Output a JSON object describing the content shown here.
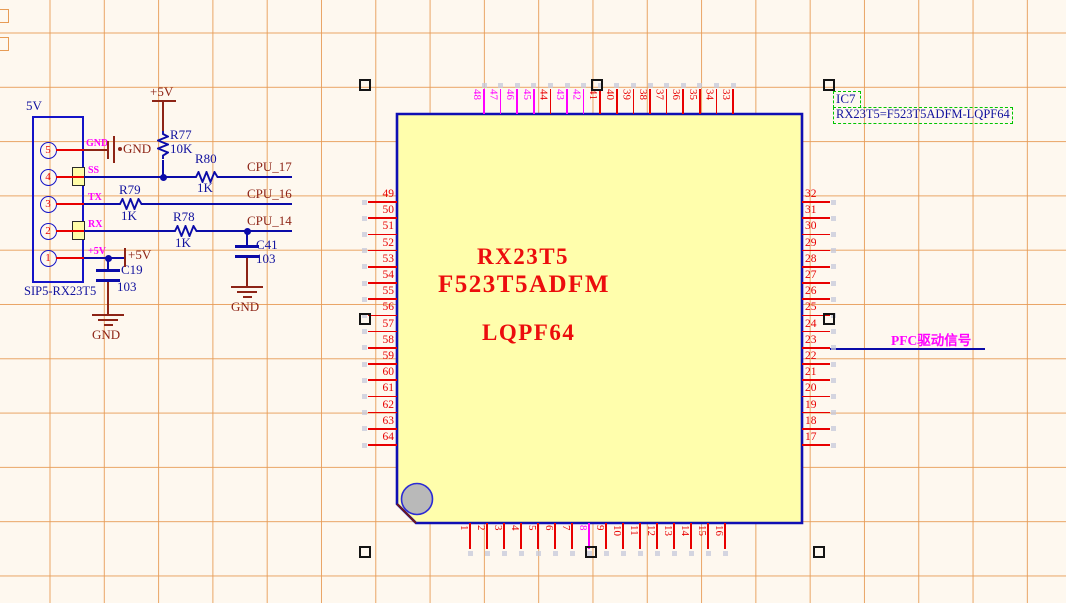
{
  "schematic": {
    "connector": {
      "power_label": "5V",
      "part_label": "SIP5-RX23T5",
      "pins": [
        {
          "num": "5",
          "name": "GND"
        },
        {
          "num": "4",
          "name": "SS"
        },
        {
          "num": "3",
          "name": "TX"
        },
        {
          "num": "2",
          "name": "RX"
        },
        {
          "num": "1",
          "name": "+5V"
        }
      ]
    },
    "resistors": [
      {
        "ref": "R77",
        "value": "10K"
      },
      {
        "ref": "R80",
        "value": "1K"
      },
      {
        "ref": "R79",
        "value": "1K"
      },
      {
        "ref": "R78",
        "value": "1K"
      }
    ],
    "capacitors": [
      {
        "ref": "C19",
        "value": "103"
      },
      {
        "ref": "C41",
        "value": "103"
      }
    ],
    "net_labels": {
      "cpu17": "CPU_17",
      "cpu16": "CPU_16",
      "cpu14": "CPU_14",
      "pfc": "PFC驱动信号"
    },
    "power_labels": {
      "plus5v": "+5V",
      "gnd": "GND"
    },
    "ic": {
      "designator": "IC7",
      "comment": "RX23T5=F523T5ADFM-LQPF64",
      "body_line1": "RX23T5",
      "body_line2": "F523T5ADFM",
      "body_line3": "LQPF64",
      "pins_top": [
        "48",
        "47",
        "46",
        "45",
        "44",
        "43",
        "42",
        "41",
        "40",
        "39",
        "38",
        "37",
        "36",
        "35",
        "34",
        "33"
      ],
      "pins_right": [
        "32",
        "31",
        "30",
        "29",
        "28",
        "27",
        "26",
        "25",
        "24",
        "23",
        "22",
        "21",
        "20",
        "19",
        "18",
        "17"
      ],
      "pins_bottom": [
        "1",
        "2",
        "3",
        "4",
        "5",
        "6",
        "7",
        "8",
        "9",
        "10",
        "11",
        "12",
        "13",
        "14",
        "15",
        "16"
      ],
      "pins_left": [
        "49",
        "50",
        "51",
        "52",
        "53",
        "54",
        "55",
        "56",
        "57",
        "58",
        "59",
        "60",
        "61",
        "62",
        "63",
        "64"
      ],
      "magenta_pins": [
        "48",
        "47",
        "46",
        "45",
        "43",
        "42",
        "8"
      ]
    },
    "colors": {
      "wire": "#0B0BA8",
      "pin_red": "#E80000",
      "pin_magenta": "#FF00FF",
      "power_maroon": "#8D2416",
      "ic_fill": "#FFFEAC",
      "ic_border": "#0F0FB4",
      "grid": "#E79C56",
      "selection_green": "#00C400",
      "ic_text_red": "#EC0D0D",
      "designator_navy": "#12129E"
    }
  }
}
